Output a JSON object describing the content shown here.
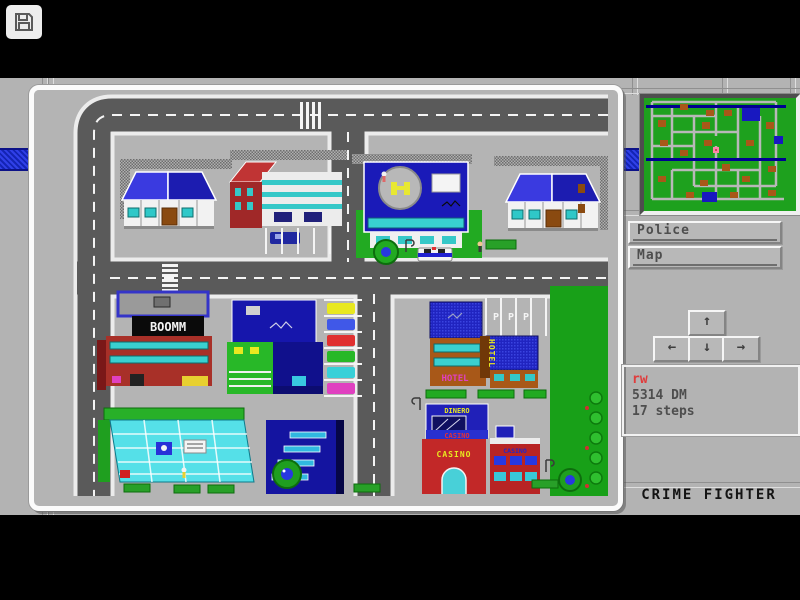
{
  "overlay": {
    "save_icon": "floppy-disk",
    "chevron": "›"
  },
  "hud": {
    "buttons": [
      {
        "label": "Police"
      },
      {
        "label": "Map"
      }
    ],
    "arrows": {
      "up": "↑",
      "left": "←",
      "down": "↓",
      "right": "→"
    },
    "status": {
      "player": "rw",
      "money": "5314 DM",
      "steps": "17 steps"
    },
    "title": "CRIME FIGHTER"
  },
  "city": {
    "signs": {
      "store": "BOOMM",
      "casino_marquee": "DINERO",
      "casino_band": "CASINO",
      "casino_front": "CASINO",
      "casino_side": "CASINO",
      "hotel_wall": "HOTEL",
      "hotel_vertical": "HOTEL",
      "parking": [
        "P",
        "P",
        "P"
      ]
    }
  },
  "minimap": {
    "player_color": "#ff86a8",
    "land_color": "#1ea11e",
    "road_color": "#b8b8b8",
    "block_colors": [
      "#a85818",
      "#1818c0"
    ]
  },
  "colors": {
    "bezel": "#b3b3b3",
    "road": "#5a5a5a",
    "stripe_blue": "#2030d8",
    "accent_red": "#e03c3c",
    "text_dark": "#4e4e4e"
  }
}
